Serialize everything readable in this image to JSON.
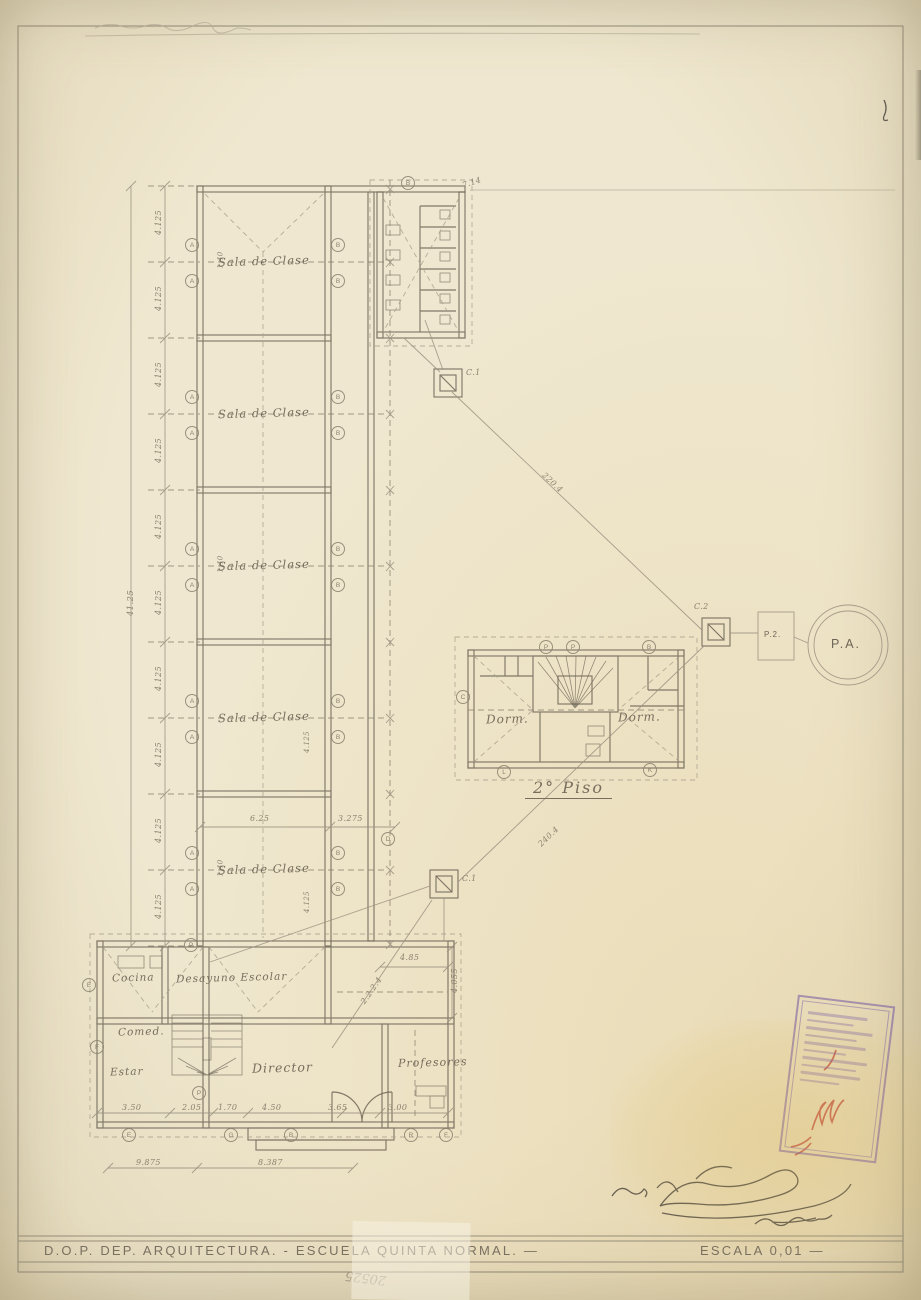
{
  "title_block": {
    "left_text": "D.O.P.  DEP.  ARQUITECTURA. - ESCUELA  QUINTA  NORMAL.  —",
    "scale_text": "ESCALA  0,01 —",
    "pencil_number": "20525"
  },
  "labels": {
    "sala": "Sala de Clase",
    "cocina": "Cocina",
    "desayuno": "Desayuno Escolar",
    "comedor": "Comed.",
    "estar": "Estar",
    "director": "Director",
    "profesores": "Profesores",
    "dorm_left": "Dorm.",
    "dorm_right": "Dorm.",
    "piso2": "2° Piso"
  },
  "sanitation": {
    "c1": "C.1",
    "c2": "C.2",
    "p2": "P.2.",
    "pa": "P.A."
  },
  "dims": {
    "seg": "4.125",
    "total": "41.25",
    "w140": "1.40",
    "room_w": "6.25",
    "corr": "3.275",
    "d485": "4.85",
    "d4055": "4.055",
    "b1": "3.50",
    "b2": "2.05",
    "b3": "1.70",
    "b4": "4.50",
    "b5": "3.65",
    "b6": "3.00",
    "r1": "9.875",
    "r2": "8.387",
    "slope_up": "220.4",
    "slope_dn": "240.4",
    "branch": "2.2.2.4",
    "corner": "7.14"
  },
  "grid_bubbles": [
    [
      191,
      244,
      "A"
    ],
    [
      191,
      280,
      "A"
    ],
    [
      191,
      396,
      "A"
    ],
    [
      191,
      432,
      "A"
    ],
    [
      191,
      548,
      "A"
    ],
    [
      191,
      584,
      "A"
    ],
    [
      191,
      700,
      "A"
    ],
    [
      191,
      736,
      "A"
    ],
    [
      191,
      852,
      "A"
    ],
    [
      191,
      888,
      "A"
    ],
    [
      337,
      244,
      "B"
    ],
    [
      337,
      280,
      "B"
    ],
    [
      337,
      396,
      "B"
    ],
    [
      337,
      432,
      "B"
    ],
    [
      337,
      548,
      "B"
    ],
    [
      337,
      584,
      "B"
    ],
    [
      337,
      700,
      "B"
    ],
    [
      337,
      736,
      "B"
    ],
    [
      337,
      852,
      "B"
    ],
    [
      337,
      888,
      "B"
    ],
    [
      407,
      182,
      "B"
    ],
    [
      387,
      838,
      "D"
    ],
    [
      545,
      646,
      "P"
    ],
    [
      572,
      646,
      "P"
    ],
    [
      648,
      646,
      "B"
    ],
    [
      462,
      696,
      "C"
    ],
    [
      503,
      771,
      "L"
    ],
    [
      649,
      769,
      "K"
    ],
    [
      88,
      984,
      "E"
    ],
    [
      96,
      1046,
      "F"
    ],
    [
      190,
      944,
      "P"
    ],
    [
      198,
      1092,
      "P"
    ],
    [
      128,
      1134,
      "E"
    ],
    [
      230,
      1134,
      "G"
    ],
    [
      290,
      1134,
      "B"
    ],
    [
      410,
      1134,
      "R"
    ],
    [
      445,
      1134,
      "F"
    ]
  ]
}
